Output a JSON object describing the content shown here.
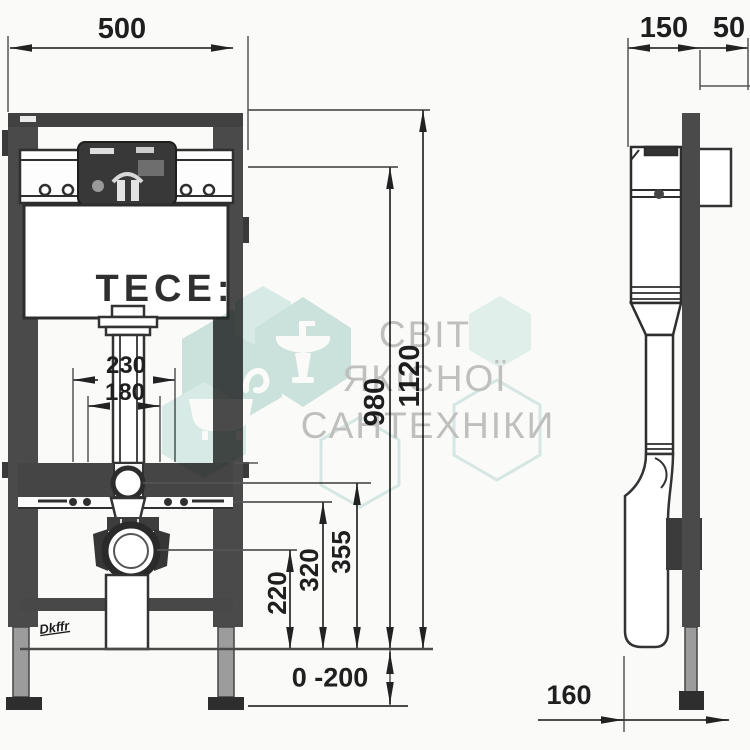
{
  "front_view": {
    "brand_logo": "TECE:",
    "stamp": "Dkffr",
    "dimensions": {
      "overall_width": "500",
      "fixing_spacing_outer": "230",
      "fixing_spacing_inner": "180",
      "actuator_height": "980",
      "overall_height": "1120",
      "drain_center_height": "220",
      "bracket_height": "320",
      "supply_height": "355",
      "leg_adjustment": "0 -200"
    }
  },
  "side_view": {
    "dimensions": {
      "frame_depth": "150",
      "wall_offset": "50",
      "drain_offset": "160"
    }
  },
  "watermark": {
    "line1": "СВІТ",
    "line2": "ЯКІСНОЇ",
    "line3": "САНТЕХНІКИ",
    "teal_color": "#cfe6e1",
    "teal_light": "#ddefeb",
    "teal_lighter": "#e6f4f0",
    "outline_color": "#d9ece8",
    "text_color": "#c3c3c3",
    "icons": [
      "washbasin-icon",
      "bathtub-icon",
      "faucet-icon"
    ]
  },
  "colors": {
    "line": "#2d2d2d",
    "dark_fill": "#454545",
    "leg_fill": "#9c9c9c",
    "background": "#fafaf9"
  }
}
